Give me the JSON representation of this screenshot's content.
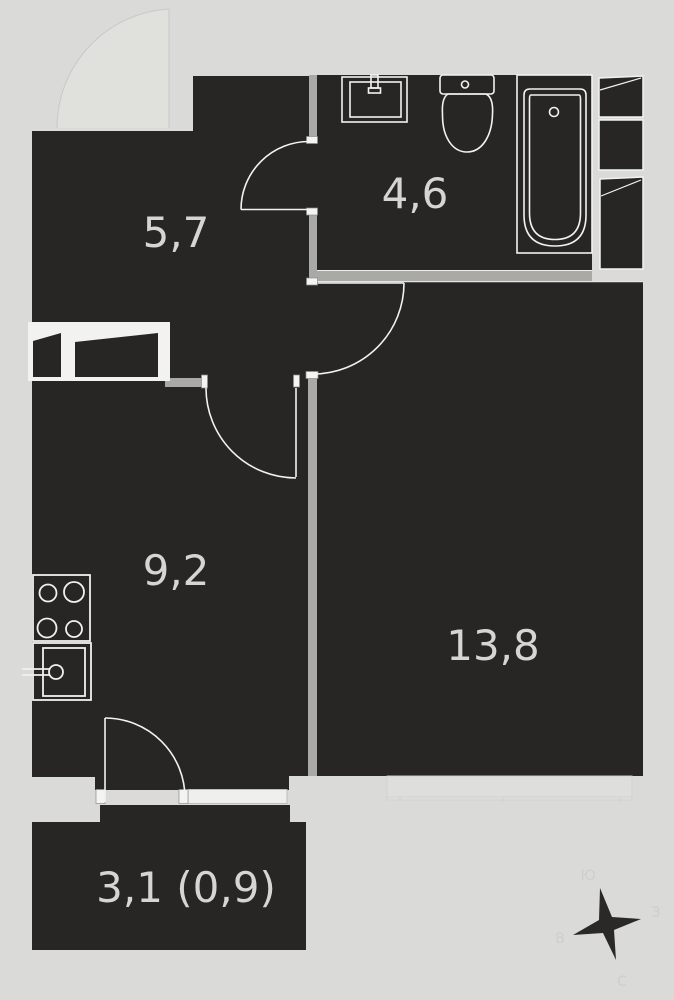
{
  "plan": {
    "kind": "apartment-floor-plan",
    "rooms": [
      {
        "id": "hallway",
        "area_label": "5,7"
      },
      {
        "id": "bathroom",
        "area_label": "4,6"
      },
      {
        "id": "kitchen",
        "area_label": "9,2"
      },
      {
        "id": "living-room",
        "area_label": "13,8"
      },
      {
        "id": "balcony",
        "area_label": "3,1 (0,9)"
      }
    ],
    "compass": {
      "top": "Ю",
      "right": "З",
      "bottom": "С",
      "left": "В"
    },
    "fixtures": [
      "bathroom-sink",
      "toilet",
      "bathtub",
      "stove",
      "kitchen-sink",
      "vent-shafts"
    ],
    "colors": {
      "background": "#dadad8",
      "room_fill": "#272624",
      "wall": "#a9a9a6",
      "outline": "#f2f2f0",
      "label_text": "#d5d5d3"
    }
  }
}
